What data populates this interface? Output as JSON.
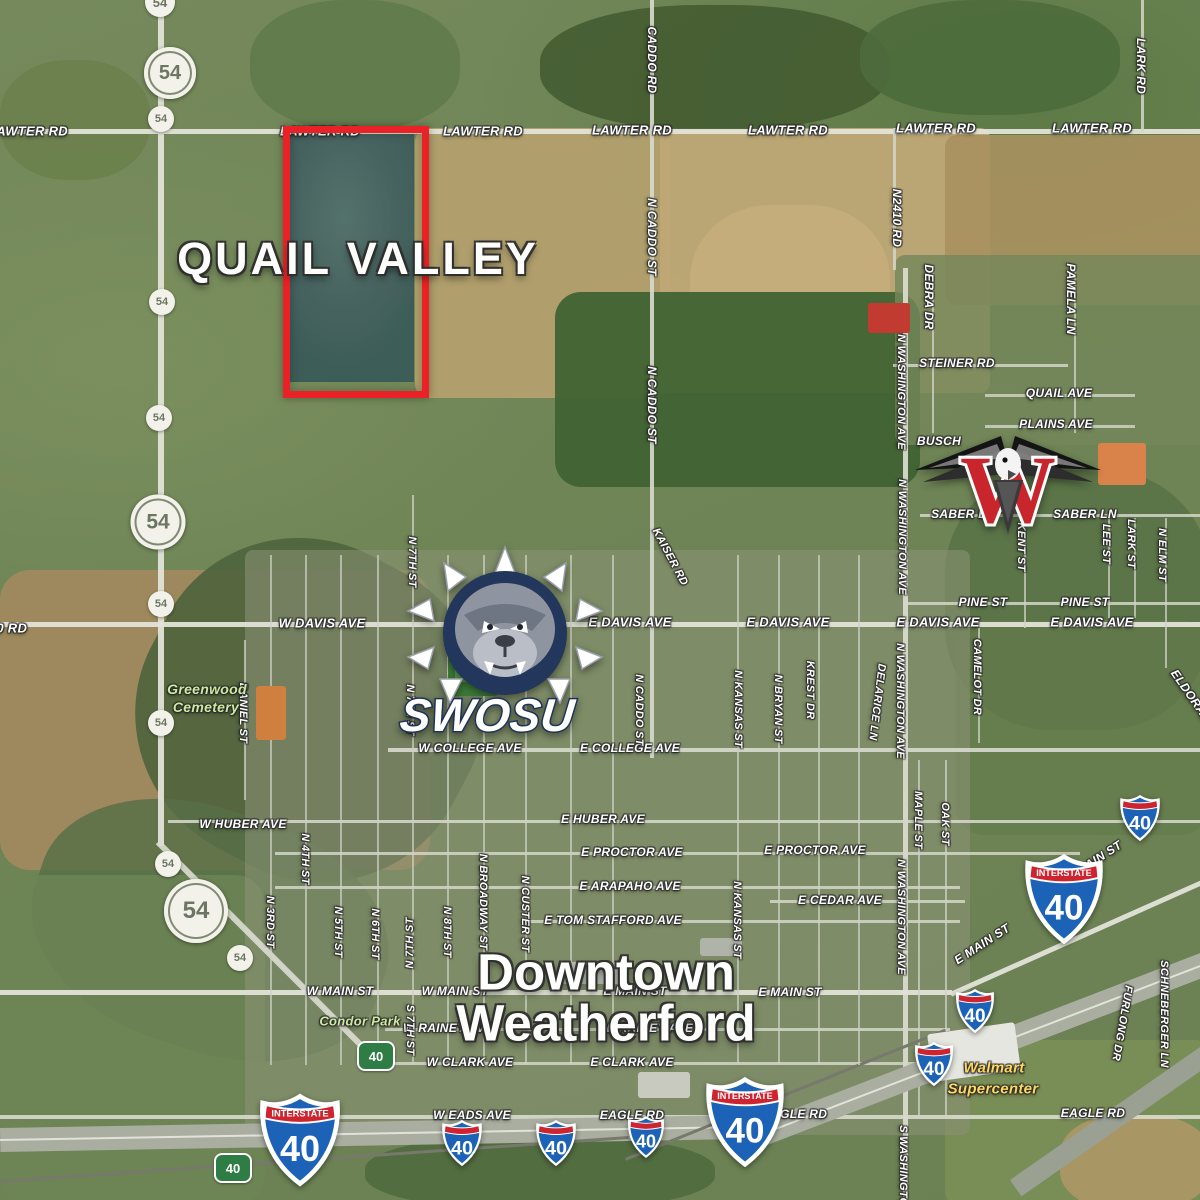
{
  "titles": {
    "quail_valley": "QUAIL VALLEY",
    "downtown_line1": "Downtown",
    "downtown_line2": "Weatherford"
  },
  "logos": {
    "swosu_wordmark": "SWOSU",
    "weatherford_w_letter": "W"
  },
  "shield_text": {
    "interstate": "INTERSTATE",
    "i40_number": "40",
    "route54_number": "54",
    "green_number": "40"
  },
  "colors": {
    "highlight_box_red": "#ea2127",
    "interstate_blue": "#1c63b7",
    "interstate_red": "#ce2430",
    "green_marker": "#2e7d44",
    "store_text": "#ffd95e",
    "park_text": "#cdeaa2",
    "swosu_navy": "#23365c",
    "eagle_red": "#c8252c"
  },
  "labels": [
    {
      "t": "LAWTER RD",
      "x": 28,
      "y": 131,
      "fs": 13
    },
    {
      "t": "LAWTER RD",
      "x": 320,
      "y": 131,
      "fs": 13,
      "under": true
    },
    {
      "t": "LAWTER RD",
      "x": 483,
      "y": 131,
      "fs": 13
    },
    {
      "t": "LAWTER RD",
      "x": 632,
      "y": 130,
      "fs": 13
    },
    {
      "t": "LAWTER RD",
      "x": 788,
      "y": 130,
      "fs": 13
    },
    {
      "t": "LAWTER RD",
      "x": 936,
      "y": 128,
      "fs": 13
    },
    {
      "t": "LAWTER RD",
      "x": 1092,
      "y": 128,
      "fs": 13
    },
    {
      "t": "CADDO RD",
      "x": 652,
      "y": 60,
      "r": 90
    },
    {
      "t": "LARK RD",
      "x": 1141,
      "y": 66,
      "r": 90
    },
    {
      "t": "N2410 RD",
      "x": 897,
      "y": 218,
      "r": 90
    },
    {
      "t": "N CADDO ST",
      "x": 652,
      "y": 237,
      "r": 90
    },
    {
      "t": "DEBRA DR",
      "x": 929,
      "y": 297,
      "r": 90
    },
    {
      "t": "PAMELA LN",
      "x": 1071,
      "y": 299,
      "r": 90
    },
    {
      "t": "N WASHINGTON AVE",
      "x": 901,
      "y": 392,
      "r": 90,
      "fs": 11
    },
    {
      "t": "STEINER RD",
      "x": 957,
      "y": 363
    },
    {
      "t": "QUAIL AVE",
      "x": 1059,
      "y": 393
    },
    {
      "t": "PLAINS AVE",
      "x": 1056,
      "y": 424
    },
    {
      "t": "BUSCH",
      "x": 939,
      "y": 441,
      "under": true
    },
    {
      "t": "N CADDO ST",
      "x": 652,
      "y": 405,
      "r": 90
    },
    {
      "t": "SABER LN",
      "x": 963,
      "y": 514,
      "under": true
    },
    {
      "t": "SABER LN",
      "x": 1085,
      "y": 514
    },
    {
      "t": "KENT ST",
      "x": 1021,
      "y": 547,
      "r": 90,
      "fs": 11
    },
    {
      "t": "LEE ST",
      "x": 1106,
      "y": 544,
      "r": 90,
      "fs": 11
    },
    {
      "t": "LARK ST",
      "x": 1131,
      "y": 544,
      "r": 90,
      "fs": 11
    },
    {
      "t": "N ELM ST",
      "x": 1162,
      "y": 555,
      "r": 90,
      "fs": 11
    },
    {
      "t": "N WASHINGTON AVE",
      "x": 902,
      "y": 537,
      "r": 90,
      "fs": 11
    },
    {
      "t": "PINE ST",
      "x": 983,
      "y": 602
    },
    {
      "t": "PINE ST",
      "x": 1085,
      "y": 602
    },
    {
      "t": "W DAVIS AVE",
      "x": 322,
      "y": 623,
      "fs": 13
    },
    {
      "t": "W DAVIS AVE",
      "x": 512,
      "y": 622,
      "fs": 13,
      "under": true
    },
    {
      "t": "E DAVIS AVE",
      "x": 630,
      "y": 622,
      "fs": 13
    },
    {
      "t": "E DAVIS AVE",
      "x": 788,
      "y": 622,
      "fs": 13
    },
    {
      "t": "E DAVIS AVE",
      "x": 938,
      "y": 622,
      "fs": 13
    },
    {
      "t": "E DAVIS AVE",
      "x": 1092,
      "y": 622,
      "fs": 13
    },
    {
      "t": "KAISER RD",
      "x": 670,
      "y": 557,
      "r": 62,
      "fs": 11
    },
    {
      "t": "ELDORADO",
      "x": 1194,
      "y": 700,
      "r": 55
    },
    {
      "t": "N 7TH ST",
      "x": 412,
      "y": 562,
      "r": 90,
      "fs": 11
    },
    {
      "t": "20 RD",
      "x": 8,
      "y": 628,
      "fs": 13
    },
    {
      "t": "N KANSAS ST",
      "x": 738,
      "y": 709,
      "r": 90,
      "fs": 11
    },
    {
      "t": "N BRYAN ST",
      "x": 778,
      "y": 709,
      "r": 90,
      "fs": 11
    },
    {
      "t": "KREST DR",
      "x": 810,
      "y": 690,
      "r": 90,
      "fs": 11
    },
    {
      "t": "DELARICE LN",
      "x": 877,
      "y": 702,
      "r": 97,
      "fs": 11
    },
    {
      "t": "N WASHINGTON AVE",
      "x": 900,
      "y": 701,
      "r": 90,
      "fs": 11
    },
    {
      "t": "CAMELOT DR",
      "x": 977,
      "y": 677,
      "r": 90,
      "fs": 11
    },
    {
      "t": "DANIEL ST",
      "x": 243,
      "y": 713,
      "r": 90,
      "fs": 11
    },
    {
      "t": "N 7TH ST",
      "x": 410,
      "y": 710,
      "r": 90,
      "fs": 11
    },
    {
      "t": "W COLLEGE AVE",
      "x": 470,
      "y": 748
    },
    {
      "t": "E COLLEGE AVE",
      "x": 630,
      "y": 748
    },
    {
      "t": "N CADDO ST",
      "x": 639,
      "y": 710,
      "r": 90,
      "fs": 11
    },
    {
      "t": "W HUBER AVE",
      "x": 243,
      "y": 824
    },
    {
      "t": "E HUBER AVE",
      "x": 603,
      "y": 819
    },
    {
      "t": "E PROCTOR AVE",
      "x": 632,
      "y": 852
    },
    {
      "t": "E PROCTOR AVE",
      "x": 815,
      "y": 850
    },
    {
      "t": "E ARAPAHO AVE",
      "x": 630,
      "y": 886
    },
    {
      "t": "E TOM STAFFORD AVE",
      "x": 613,
      "y": 920
    },
    {
      "t": "E CEDAR AVE",
      "x": 840,
      "y": 900
    },
    {
      "t": "MAPLE ST",
      "x": 918,
      "y": 820,
      "r": 90,
      "fs": 11
    },
    {
      "t": "OAK ST",
      "x": 945,
      "y": 824,
      "r": 90,
      "fs": 11
    },
    {
      "t": "N 4TH ST",
      "x": 305,
      "y": 859,
      "r": 90,
      "fs": 11
    },
    {
      "t": "N 3RD ST",
      "x": 270,
      "y": 922,
      "r": 90,
      "fs": 11
    },
    {
      "t": "N 5TH ST",
      "x": 338,
      "y": 932,
      "r": 90,
      "fs": 11
    },
    {
      "t": "N 6TH ST",
      "x": 375,
      "y": 934,
      "r": 90,
      "fs": 11
    },
    {
      "t": "N 7TH ST",
      "x": 410,
      "y": 943,
      "r": -90,
      "fs": 11
    },
    {
      "t": "N 8TH ST",
      "x": 447,
      "y": 932,
      "r": 90,
      "fs": 11
    },
    {
      "t": "N BROADWAY ST",
      "x": 483,
      "y": 902,
      "r": 90,
      "fs": 11
    },
    {
      "t": "N CUSTER ST",
      "x": 525,
      "y": 914,
      "r": 90,
      "fs": 11
    },
    {
      "t": "N KANSAS ST",
      "x": 737,
      "y": 920,
      "r": 90,
      "fs": 11
    },
    {
      "t": "N WASHINGTON AVE",
      "x": 901,
      "y": 917,
      "r": 90,
      "fs": 11
    },
    {
      "t": "E MAIN ST",
      "x": 982,
      "y": 944,
      "r": -33
    },
    {
      "t": "E MAIN ST",
      "x": 1094,
      "y": 861,
      "r": -33,
      "under": true
    },
    {
      "t": "W MAIN ST",
      "x": 340,
      "y": 991
    },
    {
      "t": "W MAIN ST",
      "x": 455,
      "y": 991,
      "under": true
    },
    {
      "t": "E MAIN ST",
      "x": 635,
      "y": 991,
      "under": true
    },
    {
      "t": "E MAIN ST",
      "x": 790,
      "y": 992
    },
    {
      "t": "W RAINEY AVE",
      "x": 448,
      "y": 1028,
      "under": true
    },
    {
      "t": "E RAINEY AVE",
      "x": 650,
      "y": 1028,
      "under": true
    },
    {
      "t": "S 7TH ST",
      "x": 410,
      "y": 1030,
      "r": 90,
      "fs": 11
    },
    {
      "t": "W CLARK AVE",
      "x": 470,
      "y": 1062
    },
    {
      "t": "E CLARK AVE",
      "x": 632,
      "y": 1062
    },
    {
      "t": "W EADS AVE",
      "x": 472,
      "y": 1115
    },
    {
      "t": "EAGLE RD",
      "x": 632,
      "y": 1115
    },
    {
      "t": "EAGLE RD",
      "x": 795,
      "y": 1114,
      "under": true
    },
    {
      "t": "EAGLE RD",
      "x": 1093,
      "y": 1113
    },
    {
      "t": "FURLONG DR",
      "x": 1122,
      "y": 1023,
      "r": 100,
      "fs": 11
    },
    {
      "t": "SCHNEBERGER LN",
      "x": 1164,
      "y": 1014,
      "r": 90,
      "fs": 11
    },
    {
      "t": "S WASHINGTON",
      "x": 903,
      "y": 1170,
      "r": 90,
      "fs": 11
    },
    {
      "t": "Greenwood",
      "x": 207,
      "y": 689,
      "k": "place",
      "fs": 14
    },
    {
      "t": "Cemetery",
      "x": 206,
      "y": 707,
      "k": "place",
      "fs": 14
    },
    {
      "t": "Condor Park",
      "x": 360,
      "y": 1021,
      "k": "place",
      "fs": 13
    },
    {
      "t": "Walmart",
      "x": 994,
      "y": 1068,
      "k": "store",
      "fs": 15
    },
    {
      "t": "Supercenter",
      "x": 993,
      "y": 1089,
      "k": "store",
      "fs": 15
    }
  ],
  "shields": [
    {
      "type": "r54",
      "d": 30,
      "x": 160,
      "y": 2
    },
    {
      "type": "r54",
      "d": 52,
      "x": 170,
      "y": 73,
      "big": true
    },
    {
      "type": "r54",
      "d": 26,
      "x": 161,
      "y": 119
    },
    {
      "type": "r54",
      "d": 26,
      "x": 162,
      "y": 302
    },
    {
      "type": "r54",
      "d": 26,
      "x": 159,
      "y": 418
    },
    {
      "type": "r54",
      "d": 55,
      "x": 158,
      "y": 522,
      "big": true
    },
    {
      "type": "r54",
      "d": 26,
      "x": 161,
      "y": 604
    },
    {
      "type": "r54",
      "d": 26,
      "x": 161,
      "y": 723
    },
    {
      "type": "r54",
      "d": 26,
      "x": 168,
      "y": 864
    },
    {
      "type": "r54",
      "d": 64,
      "x": 196,
      "y": 911,
      "big": true
    },
    {
      "type": "r54",
      "d": 26,
      "x": 240,
      "y": 958
    },
    {
      "type": "i40",
      "w": 78,
      "x": 1064,
      "y": 899,
      "big": true
    },
    {
      "type": "i40",
      "w": 78,
      "x": 745,
      "y": 1122,
      "big": true
    },
    {
      "type": "i40",
      "w": 80,
      "x": 300,
      "y": 1140,
      "big": true
    },
    {
      "type": "i40",
      "w": 40,
      "x": 1140,
      "y": 818
    },
    {
      "type": "i40",
      "w": 38,
      "x": 975,
      "y": 1011
    },
    {
      "type": "i40",
      "w": 38,
      "x": 934,
      "y": 1064
    },
    {
      "type": "i40",
      "w": 40,
      "x": 462,
      "y": 1143
    },
    {
      "type": "i40",
      "w": 40,
      "x": 556,
      "y": 1143
    },
    {
      "type": "i40",
      "w": 36,
      "x": 646,
      "y": 1137
    },
    {
      "type": "green40",
      "x": 376,
      "y": 1056
    },
    {
      "type": "green40",
      "x": 233,
      "y": 1168
    }
  ]
}
